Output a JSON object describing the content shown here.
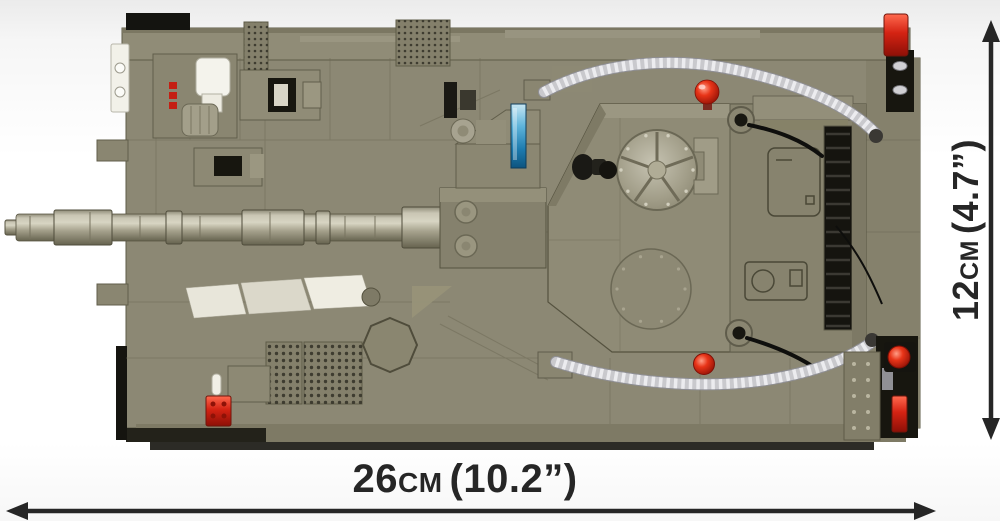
{
  "figure": {
    "subject": "olive-green brick-built battle tank model, top view",
    "style": "product dimension illustration on white background"
  },
  "dimensions": {
    "width_label": {
      "value": "26",
      "unit": "CM",
      "imperial": "(10.2”)"
    },
    "height_label": {
      "value": "12",
      "unit": "CM",
      "imperial": "(4.7”)"
    }
  },
  "colors": {
    "background": "#ffffff",
    "annotation": "#262626",
    "tank_olive": "#8c8874",
    "tank_olive_light": "#9b9780",
    "tank_olive_dark": "#6e6a56",
    "track_black": "#15140f",
    "hose_silver": "#c9c9cd",
    "signal_red": "#d42313",
    "sight_blue": "#1e7cb0",
    "white_detail": "#f2f1e9"
  },
  "parts": [
    "gun-barrel",
    "muzzle",
    "mantlet",
    "commander-hatch",
    "loader-hatch",
    "corrugated-hose-front",
    "corrugated-hose-rear",
    "red-signal-lights",
    "periscope",
    "engine-grilles",
    "tow-hooks",
    "headlight-plate",
    "octagon-hatch",
    "gunner-sight-blue",
    "stowage-grille",
    "antenna-cables"
  ]
}
